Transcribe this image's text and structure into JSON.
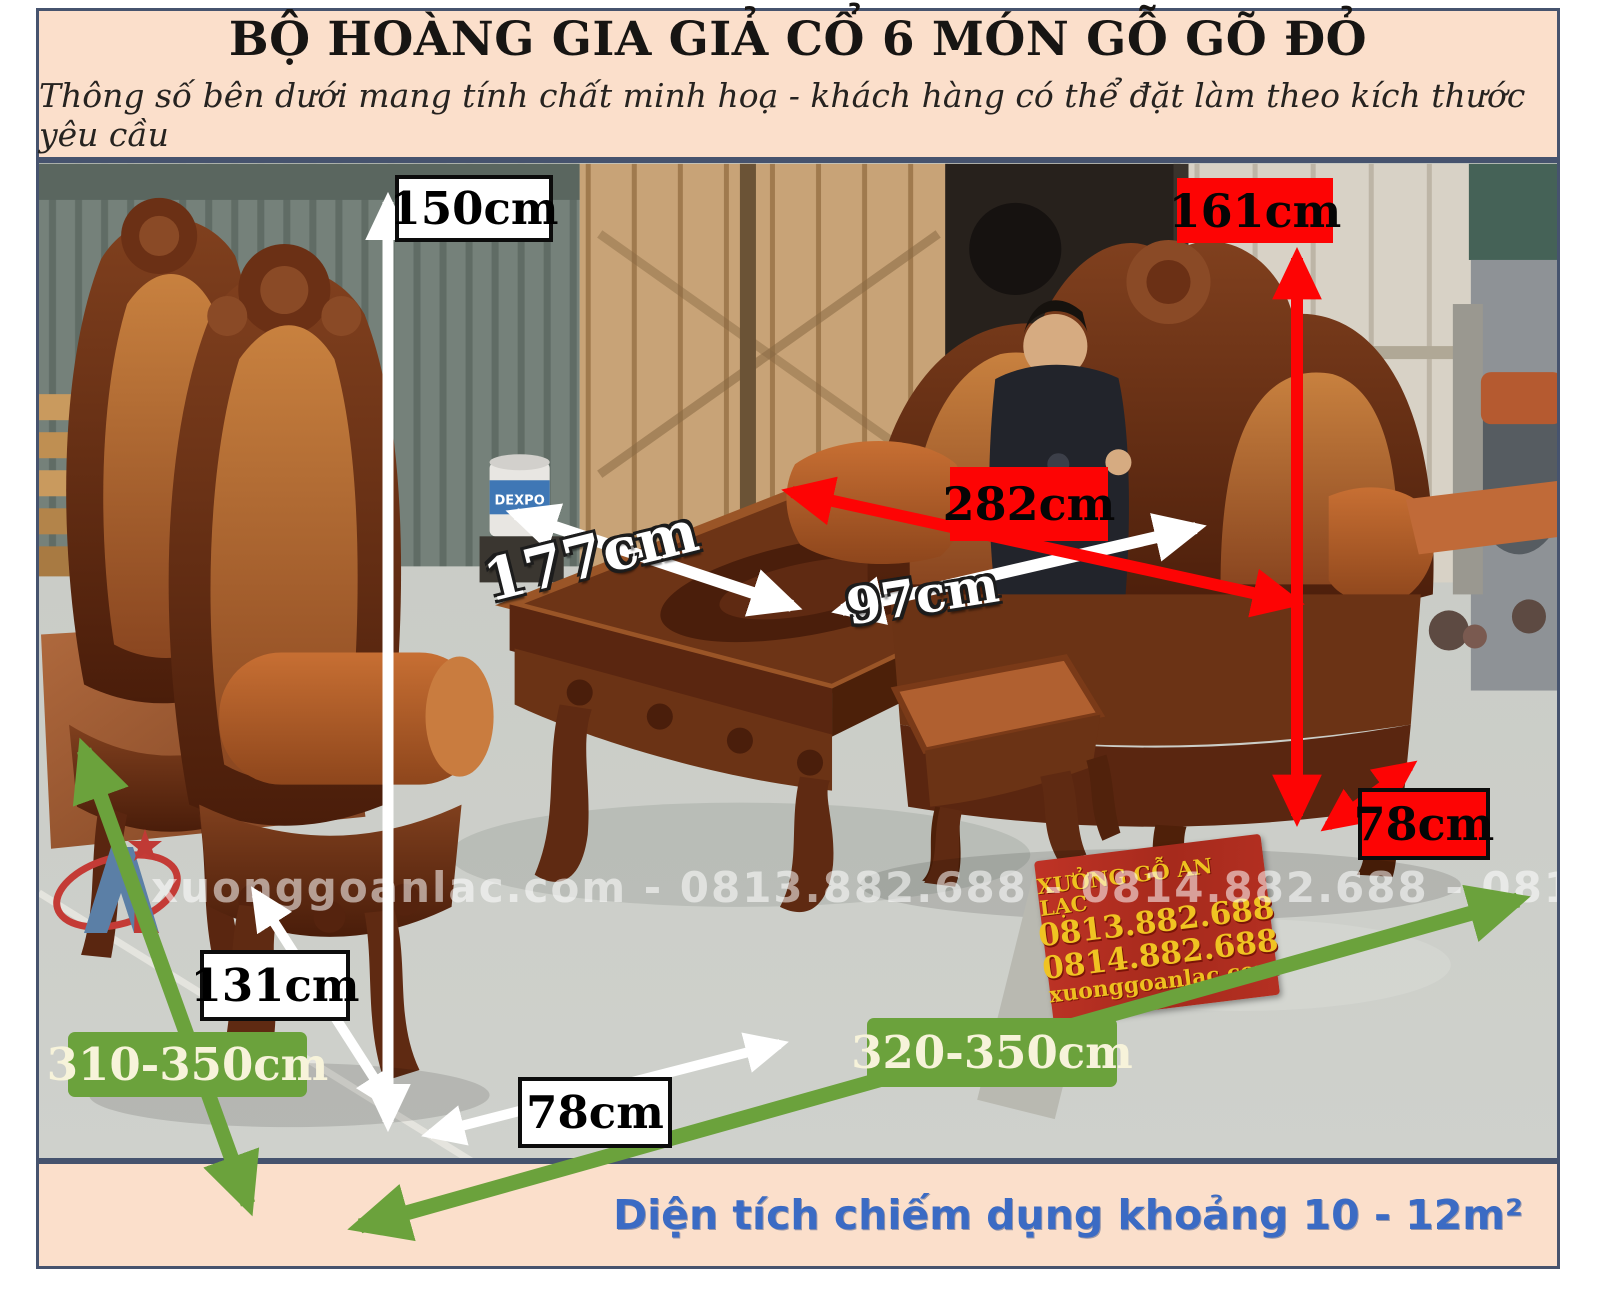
{
  "header": {
    "title": "BỘ HOÀNG GIA GIẢ CỔ 6 MÓN GỖ GÕ ĐỎ",
    "subtitle": "Thông số bên dưới mang tính chất minh hoạ - khách hàng có thể đặt làm theo kích thước yêu cầu"
  },
  "labels": {
    "chair_height": {
      "text": "150cm"
    },
    "sofa_height": {
      "text": "161cm"
    },
    "sofa_width": {
      "text": "282cm"
    },
    "table_length": {
      "text": "177cm"
    },
    "table_width": {
      "text": "97cm"
    },
    "seat_height": {
      "text": "78cm"
    },
    "chair_depth": {
      "text": "131cm"
    },
    "space_depth": {
      "text": "310-350cm"
    },
    "space_width": {
      "text": "320-350cm"
    },
    "chair_width": {
      "text": "78cm"
    }
  },
  "photo": {
    "watermark": "xuonggoanlac.com - 0813.882.688 - 0814.882.688 - 0819.882.688",
    "sign": {
      "line1": "XƯỞNG GỖ AN LẠC",
      "line2": "0813.882.688",
      "line3": "0814.882.688",
      "line4": "xuonggoanlac.com"
    },
    "bucket_label": "DEXPO"
  },
  "footer": {
    "area_note": "Diện tích chiếm dụng khoảng 10 - 12m²"
  },
  "colors": {
    "accent_red": "#FD0404",
    "accent_green": "#6BA23C",
    "panel_bg": "#FBDFCB",
    "border": "#46536E",
    "footer_text": "#3B6BC4"
  }
}
